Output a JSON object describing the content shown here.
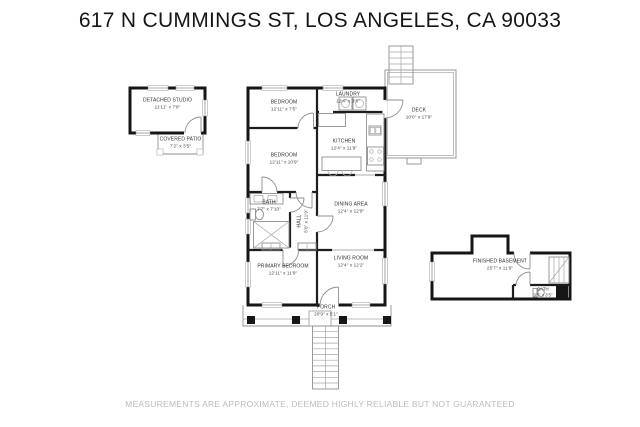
{
  "title": "617 N CUMMINGS ST, LOS ANGELES, CA 90033",
  "disclaimer": "MEASUREMENTS ARE APPROXIMATE, DEEMED HIGHLY RELIABLE BUT NOT GUARANTEED",
  "colors": {
    "wall": "#161616",
    "thin_line": "#8f8f8f",
    "label_text": "#303030",
    "disclaimer_text": "#bcbcbc",
    "background": "#ffffff"
  },
  "rooms": {
    "detached_studio": {
      "name": "DETACHED STUDIO",
      "dims": "11'11\" x 7'8\""
    },
    "covered_patio": {
      "name": "COVERED PATIO",
      "dims": "7'2\" x 3'5\""
    },
    "bedroom_top": {
      "name": "BEDROOM",
      "dims": "12'11\" x 7'5\""
    },
    "laundry": {
      "name": "LAUNDRY",
      "dims": "12'4\" x 3'6\""
    },
    "kitchen": {
      "name": "KITCHEN",
      "dims": "12'4\" x 11'9\""
    },
    "bedroom_mid": {
      "name": "BEDROOM",
      "dims": "12'11\" x 10'9\""
    },
    "bath_main": {
      "name": "BATH",
      "dims": "7'7\" x 7'10\""
    },
    "hall": {
      "name": "HALL",
      "dims": "5'0\" x 11'9\""
    },
    "dining_area": {
      "name": "DINING AREA",
      "dims": "12'4\" x 12'9\""
    },
    "primary_bedroom": {
      "name": "PRIMARY BEDROOM",
      "dims": "12'11\" x 11'9\""
    },
    "living_room": {
      "name": "LIVING ROOM",
      "dims": "12'4\" x 12'2\""
    },
    "deck": {
      "name": "DECK",
      "dims": "10'0\" x 17'9\""
    },
    "porch": {
      "name": "PORCH",
      "dims": "20'9\" x 5'1\""
    },
    "finished_basement": {
      "name": "FINISHED BASEMENT",
      "dims": "25'7\" x 11'9\""
    },
    "bath_basement": {
      "name": "BATH",
      "dims": "9'5\" x 3'5\""
    }
  }
}
